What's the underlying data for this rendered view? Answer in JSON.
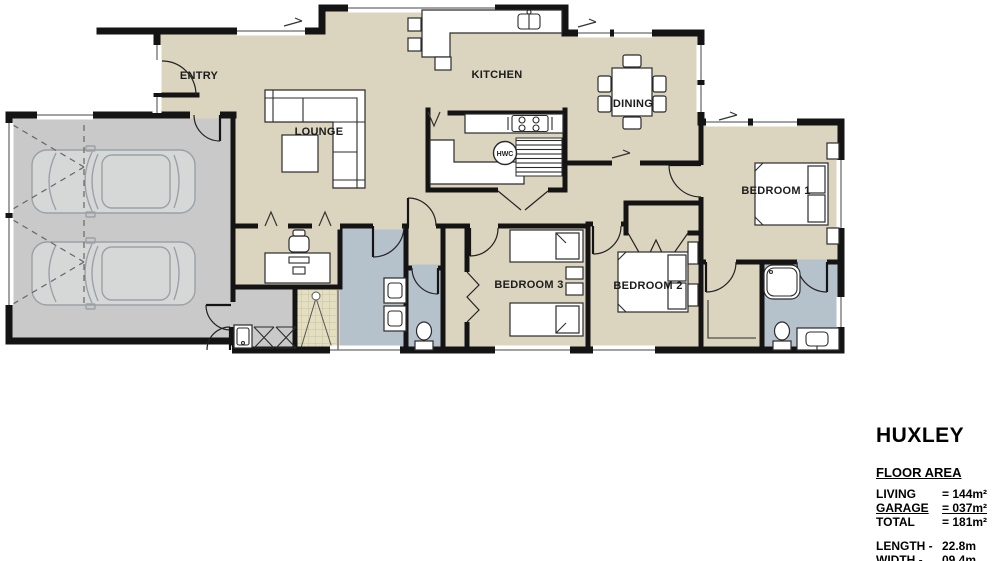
{
  "plan": {
    "rooms": {
      "entry": "ENTRY",
      "lounge": "LOUNGE",
      "kitchen": "KITCHEN",
      "dining": "DINING",
      "bedroom1": "BEDROOM 1",
      "bedroom2": "BEDROOM 2",
      "bedroom3": "BEDROOM 3"
    },
    "fixtures": {
      "hwc": "HWC"
    }
  },
  "title_block": {
    "title": "HUXLEY",
    "floor_area_heading": "FLOOR AREA",
    "areas": [
      {
        "label": "LIVING",
        "value": "= 144m²"
      },
      {
        "label": "GARAGE",
        "value": "= 037m²"
      },
      {
        "label": "TOTAL",
        "value": "= 181m²"
      }
    ],
    "dimensions": [
      {
        "label": "LENGTH -",
        "value": "22.8m"
      },
      {
        "label": "WIDTH -",
        "value": "09.4m"
      }
    ]
  },
  "colors": {
    "floor_living": "#dbd5c0",
    "floor_garage": "#c9c9c9",
    "floor_bathroom": "#b6c2cb",
    "floor_shower_tile": "#e5dfc2",
    "wall": "#141414"
  }
}
